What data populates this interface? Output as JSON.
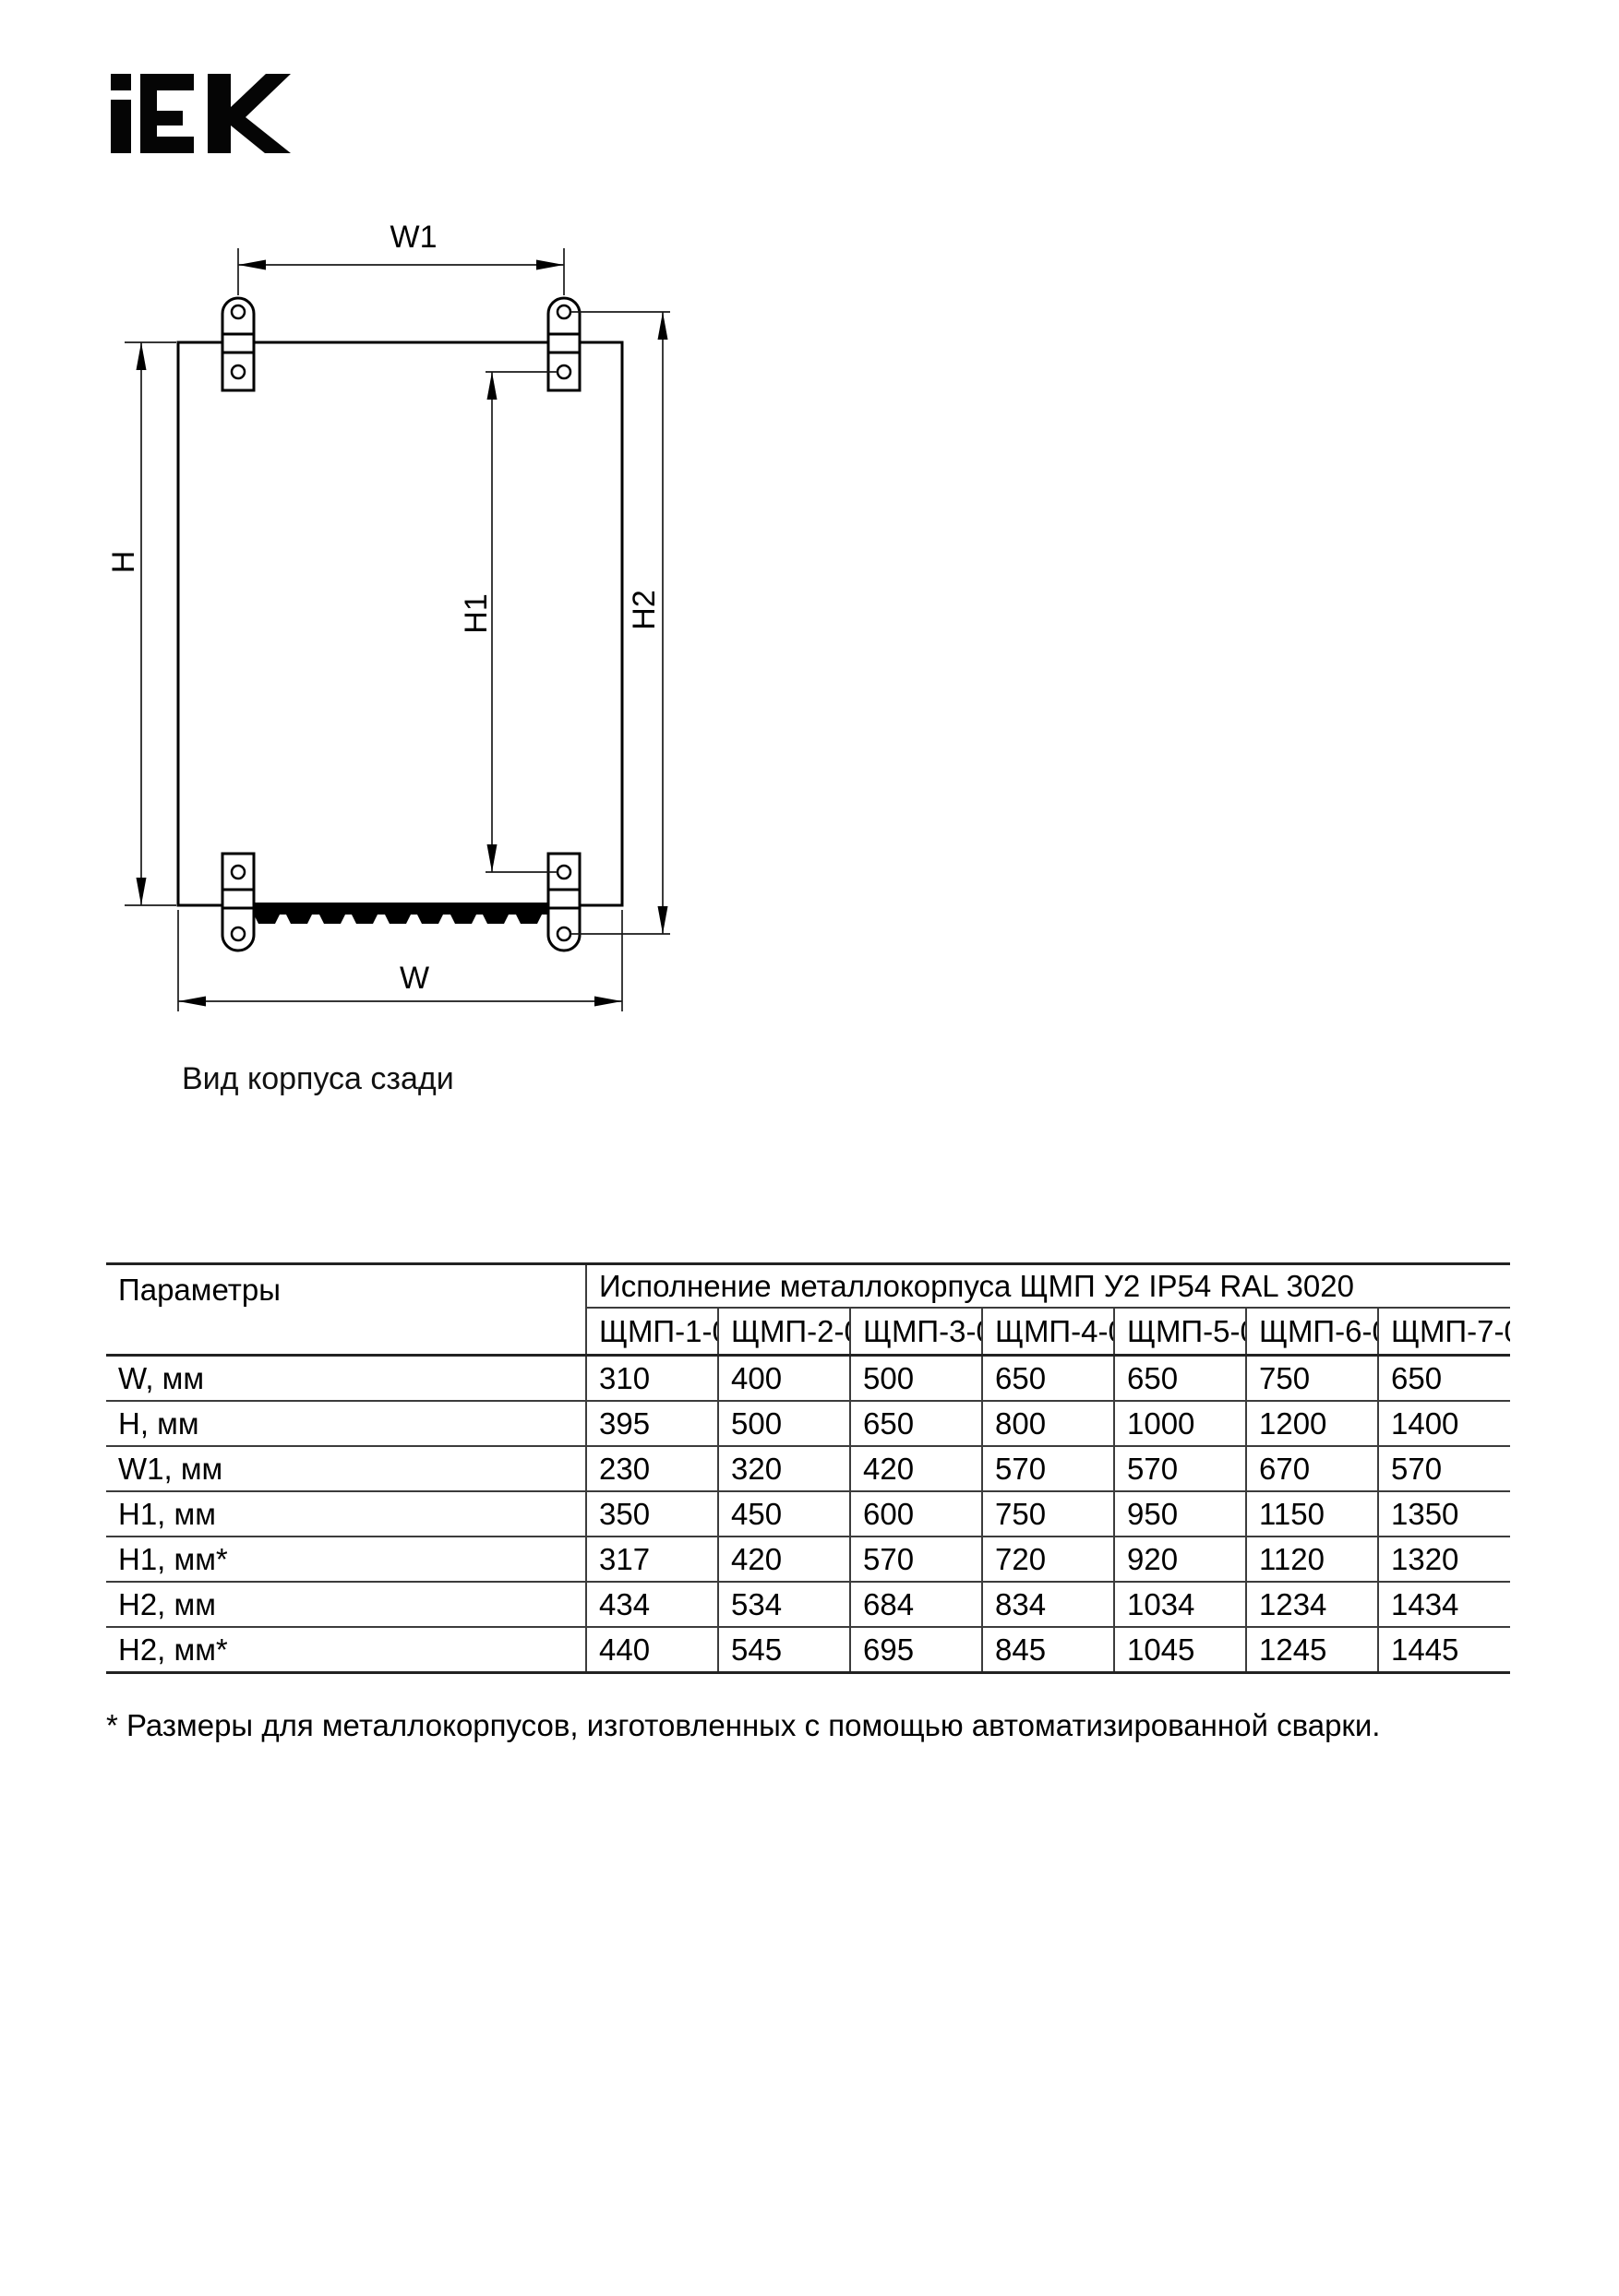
{
  "logo": {
    "text": "IEK"
  },
  "diagram": {
    "caption": "Вид корпуса сзади",
    "labels": {
      "w1": "W1",
      "w": "W",
      "h": "H",
      "h1": "H1",
      "h2": "H2"
    }
  },
  "table": {
    "param_header": "Параметры",
    "group_header": "Исполнение металлокорпуса ЩМП У2 IP54 RAL 3020",
    "columns": [
      "ЩМП-1-0",
      "ЩМП-2-0",
      "ЩМП-3-0",
      "ЩМП-4-0",
      "ЩМП-5-0",
      "ЩМП-6-0",
      "ЩМП-7-0"
    ],
    "rows": [
      {
        "label": "W, мм",
        "values": [
          "310",
          "400",
          "500",
          "650",
          "650",
          "750",
          "650"
        ]
      },
      {
        "label": "H, мм",
        "values": [
          "395",
          "500",
          "650",
          "800",
          "1000",
          "1200",
          "1400"
        ]
      },
      {
        "label": "W1, мм",
        "values": [
          "230",
          "320",
          "420",
          "570",
          "570",
          "670",
          "570"
        ]
      },
      {
        "label": "H1, мм",
        "values": [
          "350",
          "450",
          "600",
          "750",
          "950",
          "1150",
          "1350"
        ]
      },
      {
        "label": "H1, мм*",
        "values": [
          "317",
          "420",
          "570",
          "720",
          "920",
          "1120",
          "1320"
        ]
      },
      {
        "label": "H2, мм",
        "values": [
          "434",
          "534",
          "684",
          "834",
          "1034",
          "1234",
          "1434"
        ]
      },
      {
        "label": "H2, мм*",
        "values": [
          "440",
          "545",
          "695",
          "845",
          "1045",
          "1245",
          "1445"
        ]
      }
    ]
  },
  "footnote": "* Размеры для металлокорпусов, изготовленных с помощью автоматизированной сварки."
}
